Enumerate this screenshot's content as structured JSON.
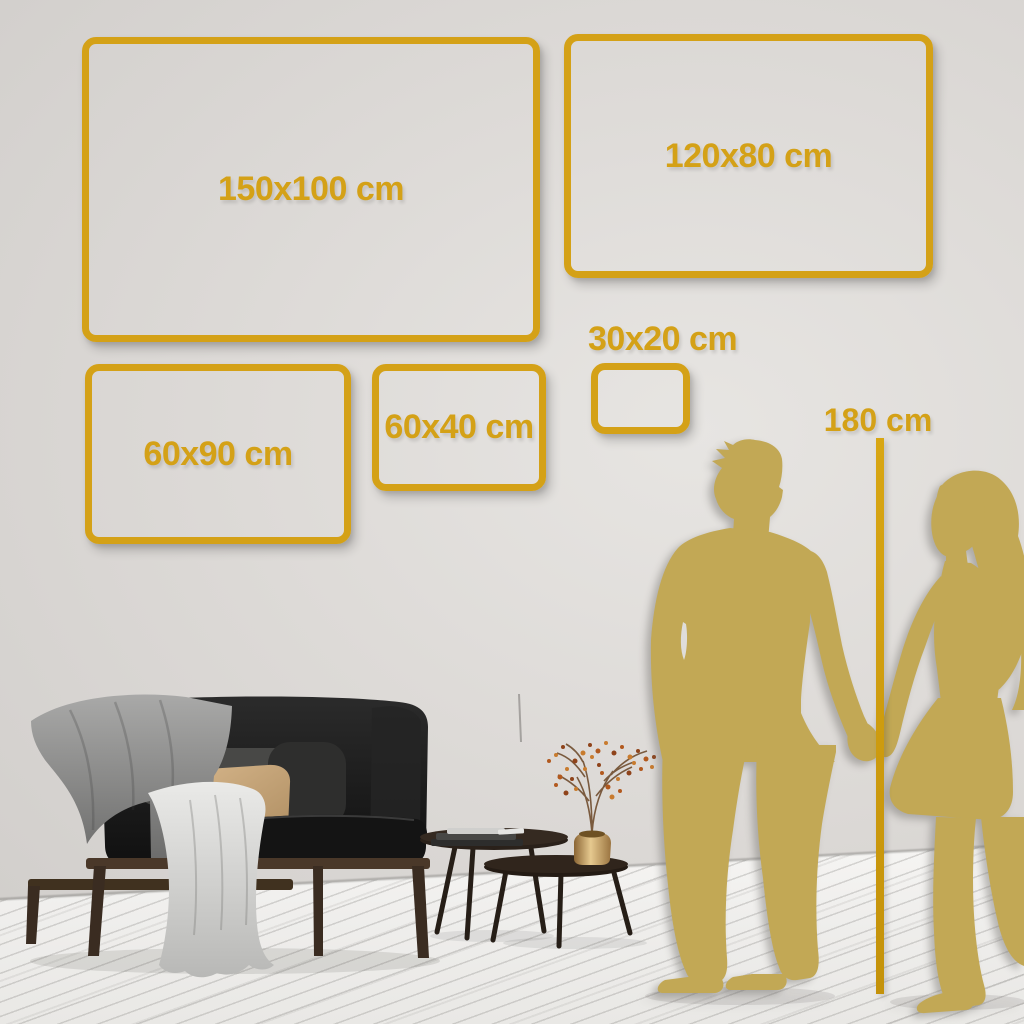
{
  "size_guide": {
    "frames": [
      {
        "label": "150x100 cm"
      },
      {
        "label": "120x80 cm"
      },
      {
        "label": "60x90 cm"
      },
      {
        "label": "60x40 cm"
      },
      {
        "label": "30x20 cm"
      }
    ],
    "height_reference": {
      "label": "180 cm"
    }
  },
  "scene_items": {
    "illustrations": [
      "sofa",
      "throw-blanket",
      "drape-cloth",
      "pillows",
      "nesting-coffee-tables",
      "books",
      "brass-vase",
      "dried-flower-branch",
      "man-silhouette",
      "woman-silhouette"
    ]
  },
  "colors": {
    "frame_gold": "#D4A117",
    "silhouette_gold": "#C2A855",
    "wall_gray": "#DEDBD8",
    "floor_white": "#EFEEEC"
  }
}
